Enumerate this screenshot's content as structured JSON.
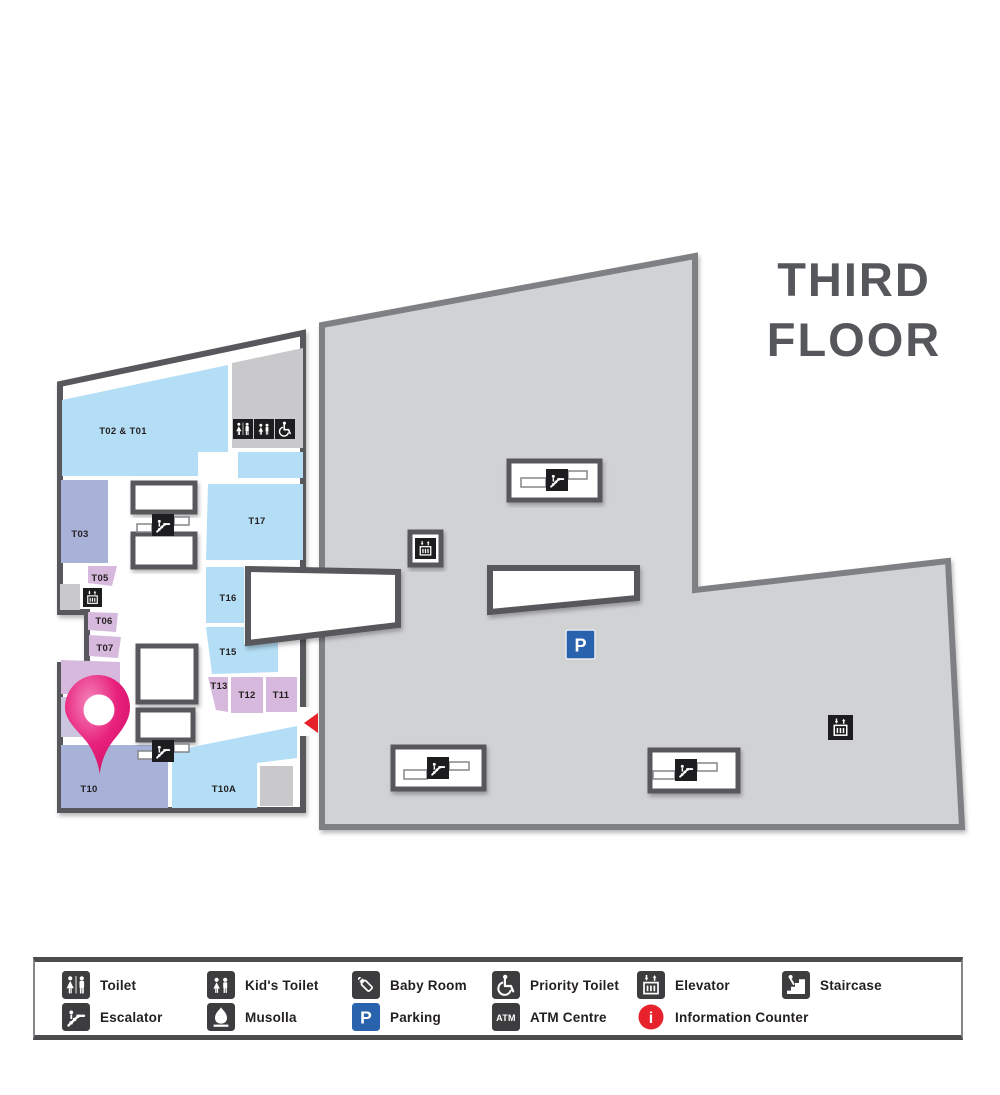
{
  "title": {
    "line1": "THIRD",
    "line2": "FLOOR"
  },
  "map": {
    "units": [
      {
        "id": "t02-t01",
        "label": "T02 & T01"
      },
      {
        "id": "t03",
        "label": "T03"
      },
      {
        "id": "t05",
        "label": "T05"
      },
      {
        "id": "t06",
        "label": "T06"
      },
      {
        "id": "t07",
        "label": "T07"
      },
      {
        "id": "t09",
        "label": "T09"
      },
      {
        "id": "t10",
        "label": "T10"
      },
      {
        "id": "t10a",
        "label": "T10A"
      },
      {
        "id": "t11",
        "label": "T11"
      },
      {
        "id": "t12",
        "label": "T12"
      },
      {
        "id": "t13",
        "label": "T13"
      },
      {
        "id": "t15",
        "label": "T15"
      },
      {
        "id": "t16",
        "label": "T16"
      },
      {
        "id": "t17",
        "label": "T17"
      }
    ],
    "colors": {
      "light_blue": "#b3def5",
      "periwinkle": "#a8b2d9",
      "lilac": "#d6b9dc",
      "lavender": "#cbc5e0",
      "concrete_gray": "#c9c9cb",
      "floor_gray": "#d1d2d4",
      "wall_dark": "#58595b",
      "pin_pink": "#e8217c",
      "arrow_red": "#e62129",
      "parking_blue": "#2a63ad",
      "info_red": "#e8222d"
    }
  },
  "icons": {
    "parking_letter": "P",
    "atm_label": "ATM",
    "info_letter": "i"
  },
  "legend": {
    "items": [
      {
        "icon": "toilet-icon",
        "label": "Toilet"
      },
      {
        "icon": "kids-toilet-icon",
        "label": "Kid's Toilet"
      },
      {
        "icon": "baby-room-icon",
        "label": "Baby Room"
      },
      {
        "icon": "priority-toilet-icon",
        "label": "Priority Toilet"
      },
      {
        "icon": "elevator-icon",
        "label": "Elevator"
      },
      {
        "icon": "staircase-icon",
        "label": "Staircase"
      },
      {
        "icon": "escalator-icon",
        "label": "Escalator"
      },
      {
        "icon": "musolla-icon",
        "label": "Musolla"
      },
      {
        "icon": "parking-icon",
        "label": "Parking"
      },
      {
        "icon": "atm-icon",
        "label": "ATM Centre"
      },
      {
        "icon": "info-icon",
        "label": "Information Counter"
      }
    ]
  }
}
